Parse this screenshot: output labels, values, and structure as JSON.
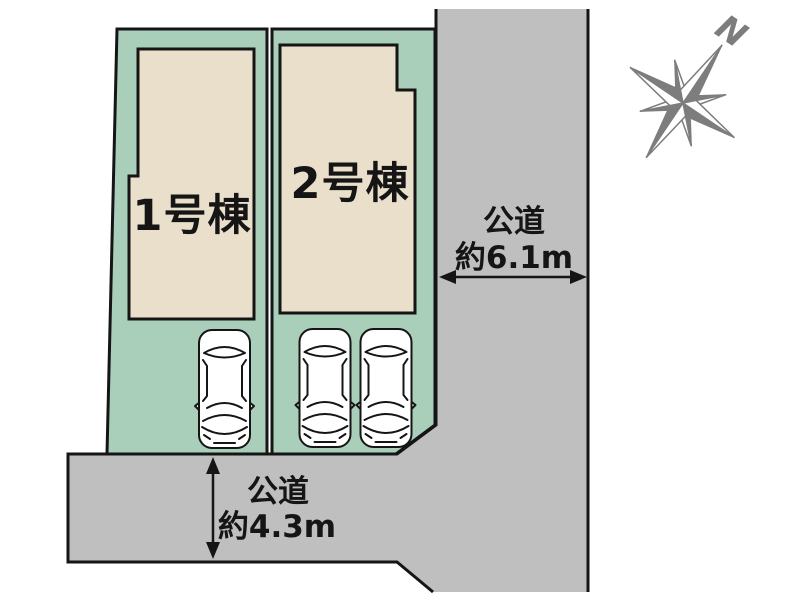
{
  "palette": {
    "bg": "#ffffff",
    "plot-green": "#a9cfbb",
    "building-beige": "#e9dfcb",
    "road-gray": "#bfbfbf",
    "line": "#151515",
    "text": "#151515",
    "car-white": "#ffffff",
    "compass": "#7d7d7d"
  },
  "buildings": [
    {
      "label": "1号棟"
    },
    {
      "label": "2号棟"
    }
  ],
  "roads": {
    "east": {
      "name": "公道",
      "width": "約6.1m"
    },
    "south": {
      "name": "公道",
      "width": "約4.3m"
    }
  },
  "compass": {
    "north_label": "N"
  },
  "cars": {
    "count": 3
  }
}
